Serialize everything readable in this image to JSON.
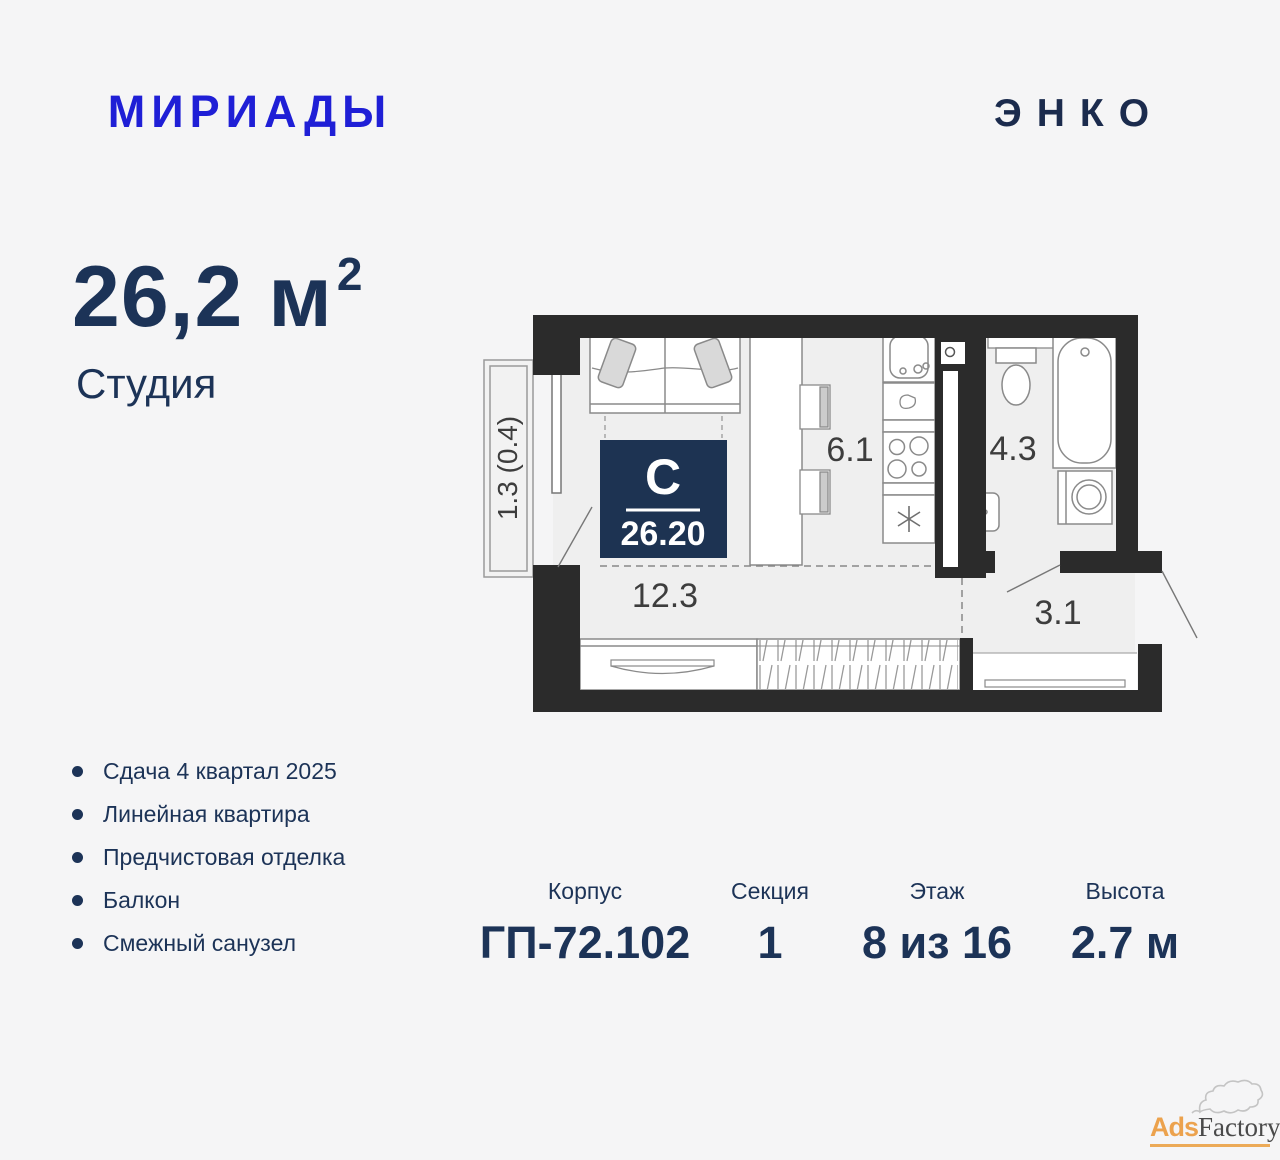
{
  "header": {
    "project_logo": "МИРИАДЫ",
    "developer_logo": "ЭНКО"
  },
  "summary": {
    "area_value": "26,2",
    "area_unit": "м",
    "area_exponent": "2",
    "apartment_type": "Студия"
  },
  "features": {
    "items": [
      "Сдача 4 квартал 2025",
      "Линейная квартира",
      "Предчистовая отделка",
      "Балкон",
      "Смежный санузел"
    ]
  },
  "specs": {
    "columns": [
      {
        "label": "Корпус",
        "value": "ГП-72.102"
      },
      {
        "label": "Секция",
        "value": "1"
      },
      {
        "label": "Этаж",
        "value": "8 из 16"
      },
      {
        "label": "Высота",
        "value": "2.7 м"
      }
    ]
  },
  "plan": {
    "badge": {
      "type_letter": "С",
      "area": "26.20"
    },
    "labels": {
      "living": "12.3",
      "kitchen": "6.1",
      "bathroom": "4.3",
      "hall": "3.1",
      "balcony": "1.3 (0.4)"
    }
  },
  "watermark": {
    "prefix": "Ads",
    "suffix": "Factory"
  },
  "colors": {
    "accent_navy": "#1c3357",
    "logo_blue": "#1f1fd6",
    "developer_navy": "#1b2b4d",
    "badge_navy": "#1d3352",
    "wall_black": "#2b2b2b",
    "watermark_orange": "#eca24d"
  }
}
